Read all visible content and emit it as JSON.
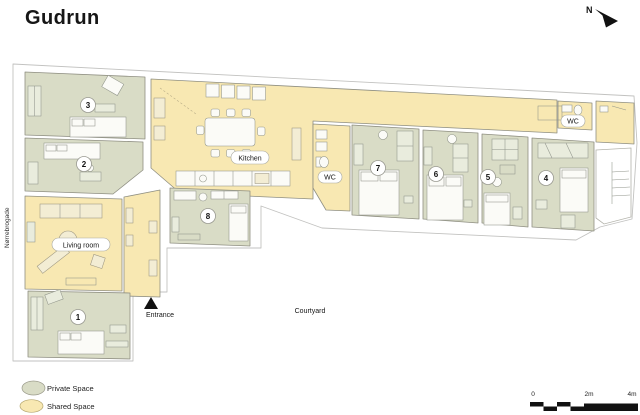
{
  "title": "Gudrun",
  "compass": {
    "label": "N"
  },
  "street": {
    "label": "Nørrebrogade"
  },
  "plan": {
    "room_labels": {
      "kitchen": "Kitchen",
      "living_room": "Living room",
      "wc_left": "WC",
      "wc_right": "WC"
    },
    "room_numbers": [
      "1",
      "2",
      "3",
      "4",
      "5",
      "6",
      "7",
      "8"
    ],
    "annotations": {
      "courtyard": "Courtyard",
      "entrance": "Entrance"
    }
  },
  "legend": {
    "items": [
      {
        "label": "Private Space",
        "color": "#d9dcc6"
      },
      {
        "label": "Shared Space",
        "color": "#f8e8b2"
      }
    ]
  },
  "scale_bar": {
    "ticks": [
      "0",
      "2m",
      "4m"
    ]
  },
  "colors": {
    "private": "#d9dcc6",
    "shared": "#f8e8b2",
    "marker": "#111111"
  }
}
